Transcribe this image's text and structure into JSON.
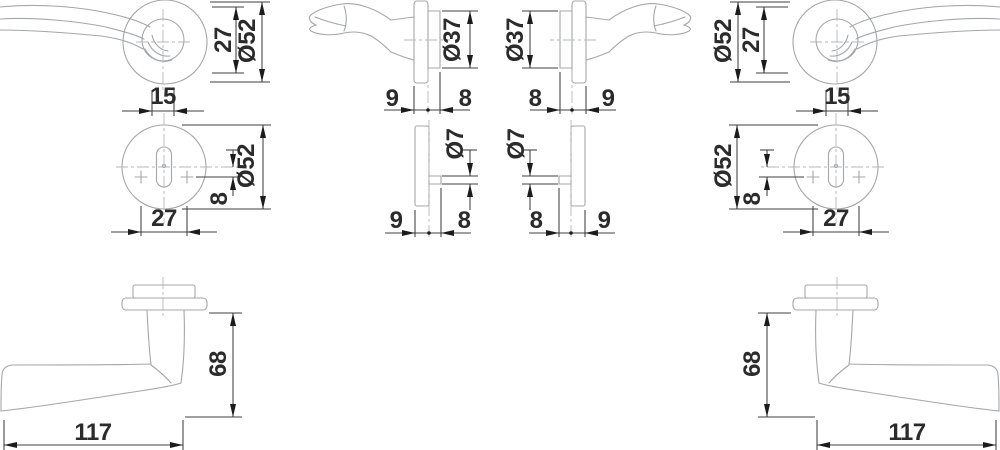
{
  "drawing": {
    "description": "Technical dimension drawing of a lever door handle set with round rose and key escutcheon, left and right handed views",
    "colors": {
      "background": "#ffffff",
      "outline": "#a3a7aa",
      "dimension_lines": "#3f3f3f",
      "dimension_text": "#2b2b2b"
    },
    "views": {
      "handle_top": {
        "label_height": "27",
        "label_diameter": "Ø52",
        "label_neck": "15"
      },
      "rose_side": {
        "label_diameter": "Ø37",
        "label_front": "9",
        "label_back": "8"
      },
      "escutcheon_front": {
        "label_diameter": "Ø52",
        "label_offset": "8",
        "label_width": "27"
      },
      "escutcheon_side": {
        "label_diameter": "Ø7",
        "label_front": "9",
        "label_back": "8"
      },
      "lever_side": {
        "label_height": "68",
        "label_length": "117"
      }
    }
  }
}
